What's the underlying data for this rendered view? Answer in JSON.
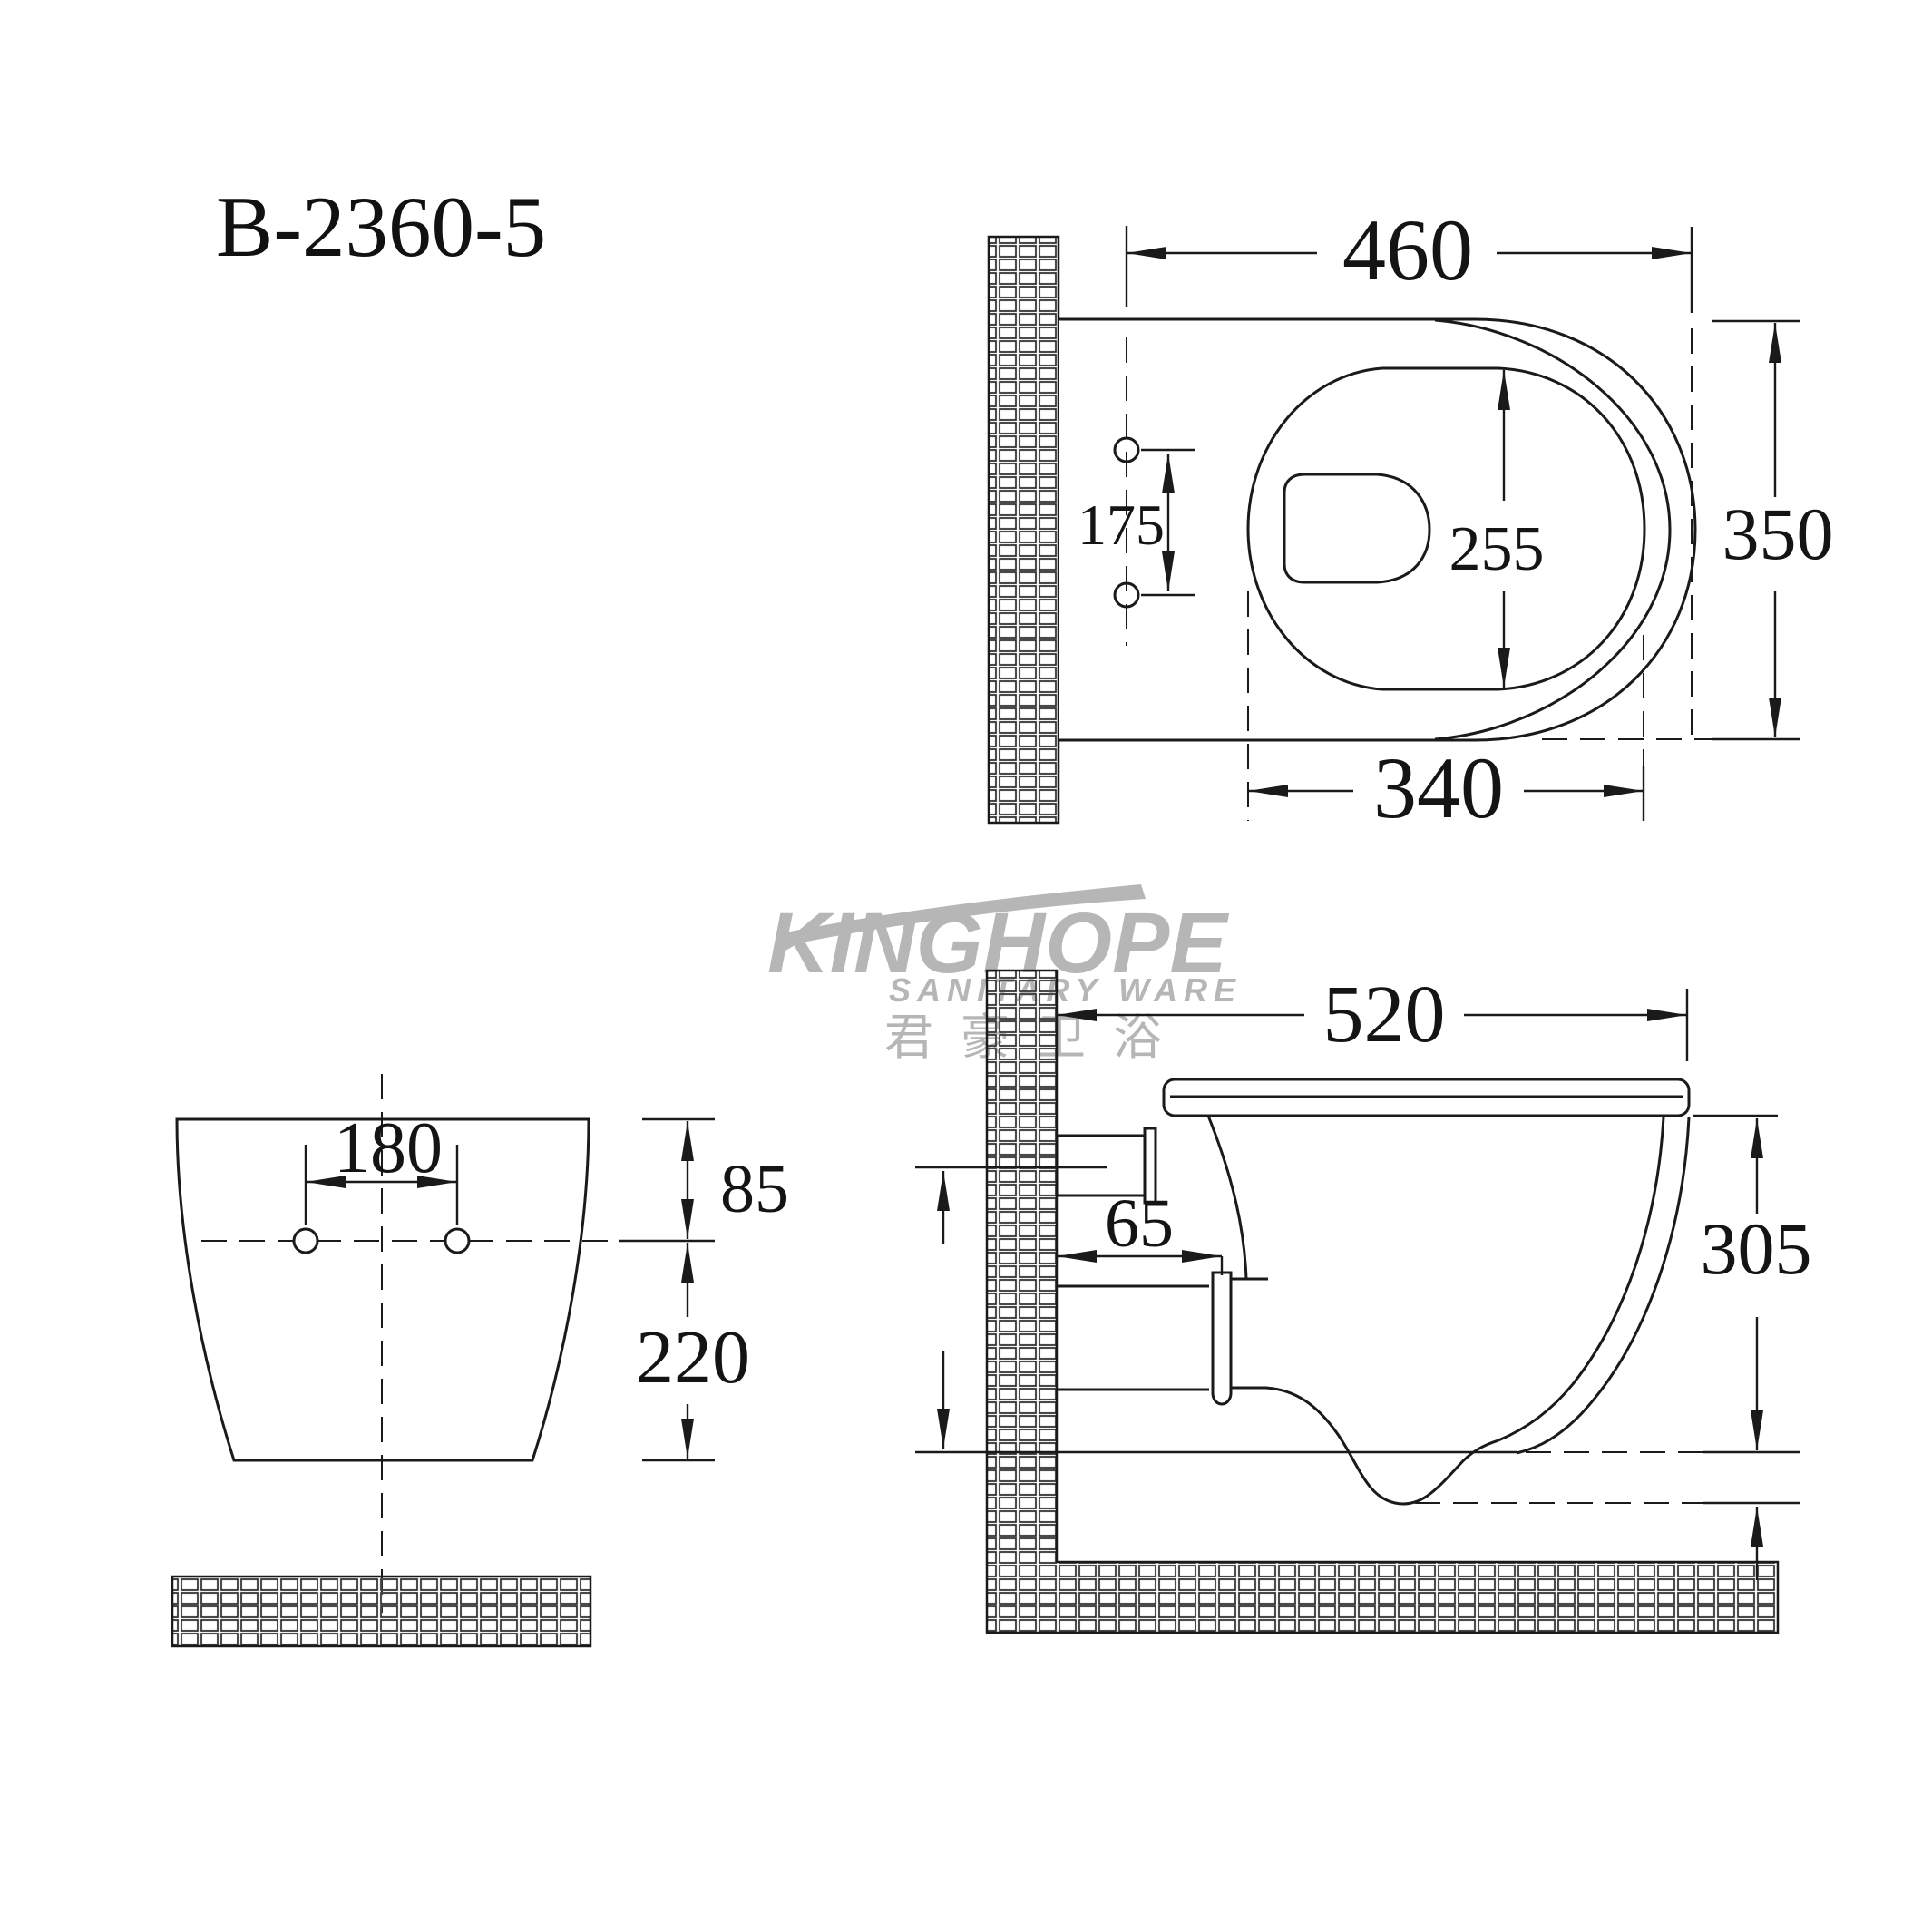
{
  "title": {
    "model": "B-2360-5"
  },
  "watermark": {
    "brand": "KINGHOPE",
    "tagline": "SANITARY WARE",
    "chinese": "君豪卫浴"
  },
  "views": {
    "top": {
      "dims": {
        "overall_width": "460",
        "overall_depth": "350",
        "bowl_length": "255",
        "bowl_width": "340",
        "hole_spacing": "175"
      }
    },
    "front": {
      "dims": {
        "hole_spacing": "180",
        "top_to_holes": "85",
        "holes_to_bottom": "220"
      }
    },
    "side": {
      "dims": {
        "depth": "520",
        "drain_offset": "65",
        "height": "305"
      }
    }
  },
  "colors": {
    "line": "#1a1a1a",
    "watermark": "#b6b6b6",
    "background": "#ffffff"
  }
}
